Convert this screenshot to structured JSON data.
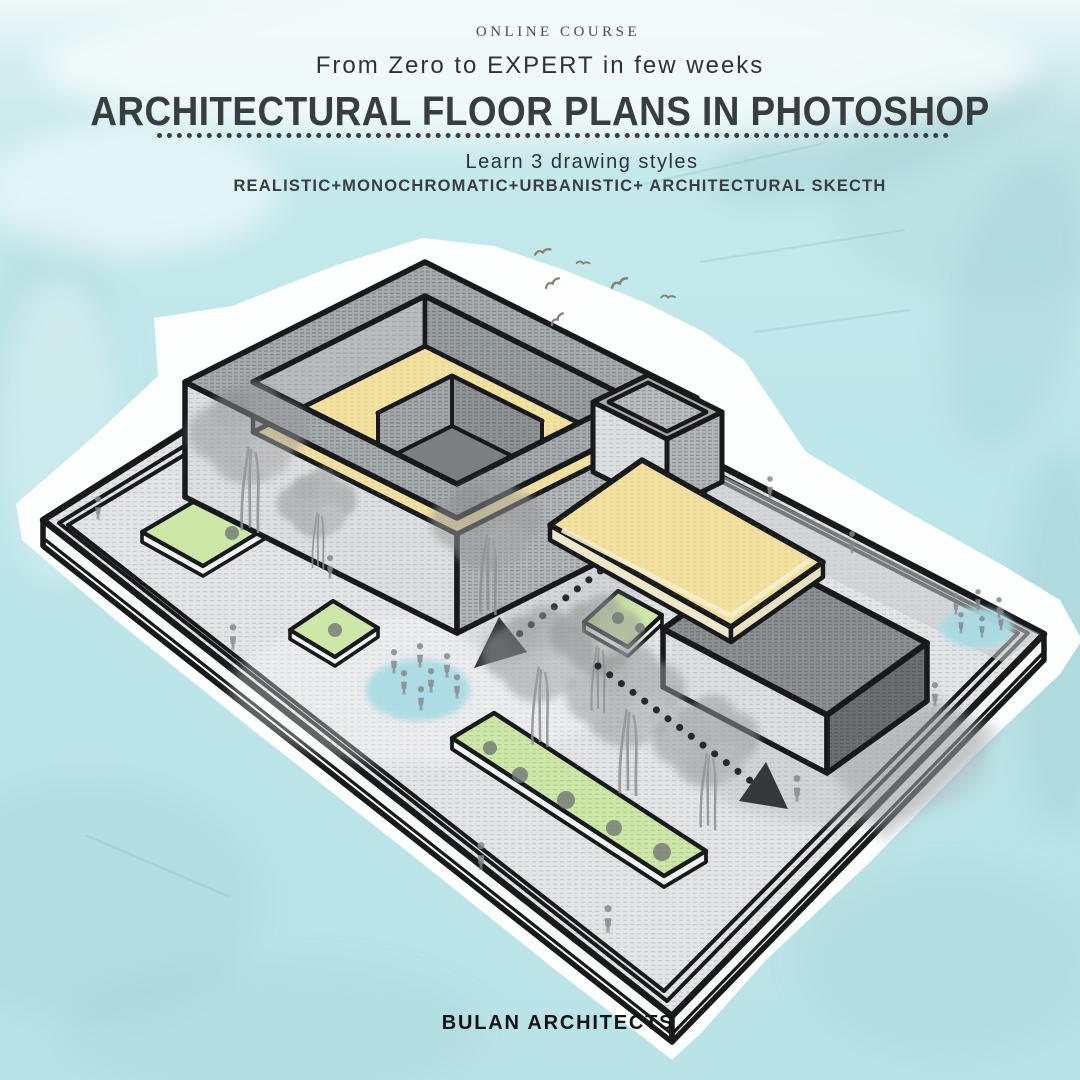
{
  "header": {
    "eyebrow": "ONLINE COURSE",
    "subtitle": "From Zero to EXPERT in few weeks",
    "title": "ARCHITECTURAL FLOOR PLANS IN PHOTOSHOP",
    "tagline": "Learn 3 drawing styles",
    "styles_line": "REALISTIC+MONOCHROMATIC+URBANISTIC+ ARCHITECTURAL SKECTH"
  },
  "footer": {
    "brand": "BULAN ARCHITECTS"
  },
  "illustration": {
    "description": "Hand-sketched isometric site plan: courtyard building with yellow roof, raised end block, yellow canopy slab and dark annex box on a plinth with lawns, trees, plazas, pedestrians, dotted circulation arrows and birds",
    "elements": {
      "buildings": [
        "courtyard ring building with yellow roof",
        "raised end block",
        "yellow canopy slab",
        "dark annex box"
      ],
      "green_strips": 4,
      "trees": 7,
      "shrubs": 9,
      "plaza_ellipses": 2,
      "pedestrians": 22,
      "birds": 6,
      "dotted_paths": 2,
      "arrowheads": 2
    },
    "colors": {
      "bg": "#bfe7ea",
      "wash_dark": "#96c2c7",
      "halo": "#fdfefe",
      "ink": "#17191b",
      "platform_top": "#e2e4e6",
      "platform_side": "#f8fafa",
      "walkway_gray": "#c6cacc",
      "parapet_gray": "#a6aaad",
      "parapet_light": "#b8bcbe",
      "parapet_shaded": "#989da0",
      "wall_light": "#dcdfe1",
      "wall_mid": "#b2b6b9",
      "roof_yellow": "#f3e1a0",
      "slab_cream": "#efe7ca",
      "court_wall": "#a3a7aa",
      "court_wall2": "#8f9396",
      "court_floor": "#7b7f82",
      "box_top": "#8c9093",
      "box_side": "#6b6f72",
      "lawn_green": "#cde7a6",
      "pond_blue": "#a8dbe4",
      "tree_gray": "#97989a",
      "shrub_gray": "#6d7271",
      "figure_gray": "#85898b",
      "shadow_gray": "#8f9598",
      "path_ink": "#27292b",
      "bird_brown": "#8b7f74",
      "title_ink": "#383d40",
      "text_ink": "#2d3236",
      "eyebrow_ink": "#4e4b46",
      "brand_ink": "#141414"
    }
  }
}
